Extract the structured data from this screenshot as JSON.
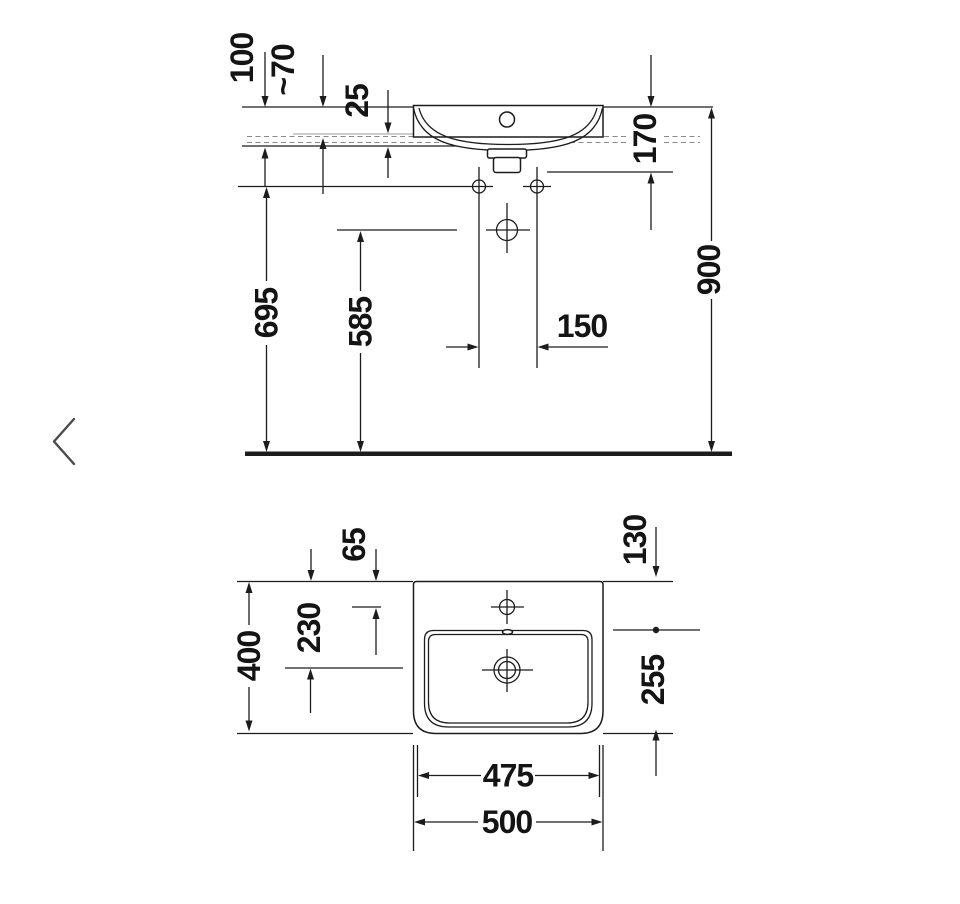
{
  "carousel": {
    "prev_icon": "chevron-left"
  },
  "drawing": {
    "front_view": {
      "dim_100": "100",
      "dim_70": "~70",
      "dim_25": "25",
      "dim_170": "170",
      "dim_695": "695",
      "dim_585": "585",
      "dim_150": "150",
      "dim_900": "900"
    },
    "plan_view": {
      "dim_65": "65",
      "dim_130": "130",
      "dim_230": "230",
      "dim_400": "400",
      "dim_255": "255",
      "dim_475": "475",
      "dim_500": "500"
    },
    "line_color": "#1c1c1c",
    "text_color": "#141414"
  }
}
